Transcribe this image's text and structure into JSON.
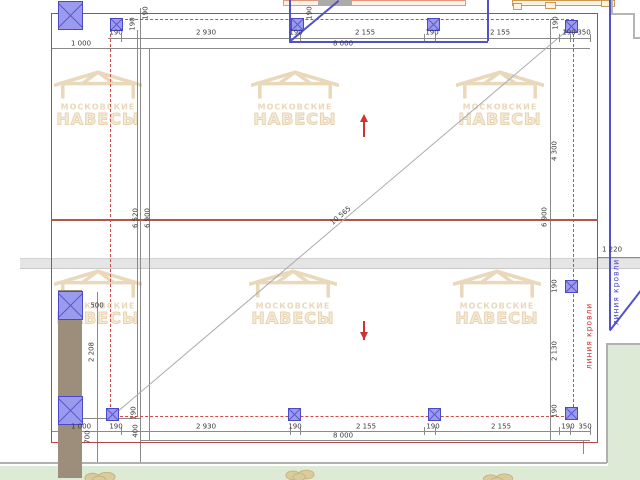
{
  "title": "canopy-plan-drawing",
  "brand": {
    "line1": "МОСКОВСКИЕ",
    "line2": "НАВЕСЫ"
  },
  "colors": {
    "plan_border": "#b84444",
    "dashed": "#cc4c4c",
    "mid_line": "#b05848",
    "blue": "#5252c8",
    "post_fill": "#9a9aee",
    "dim_line": "#8a8a8a",
    "dim_text": "#3a3a3a",
    "watermark": "#e7d2b0",
    "brown": "#9d8d7b",
    "green": "#dcead6",
    "fence": "#e5e5e5",
    "salmon": "#e09878",
    "orange": "#cd9850",
    "grey_struct": "#ababab",
    "red_label": "#cc3333",
    "blue_label": "#4848c8"
  },
  "chart_data": {
    "type": "table",
    "title": "План навеса (размеры, мм)",
    "top_dimensions": [
      "190",
      "2 930",
      "190",
      "2 155",
      "190",
      "2 155",
      "190",
      "350"
    ],
    "top_totals": [
      "1 000",
      "8 000"
    ],
    "bottom_dimensions": [
      "1 000",
      "190",
      "2 930",
      "190",
      "2 155",
      "190",
      "2 155",
      "190",
      "350"
    ],
    "bottom_totals": [
      "8 000"
    ],
    "left_dimensions": [
      "6 520",
      "6 900",
      "500",
      "2 208",
      "190",
      "400",
      "700"
    ],
    "right_dimensions": [
      "190",
      "4 300",
      "190",
      "2 130",
      "190",
      "6 900",
      "350",
      "1 220"
    ],
    "diagonal": "10 565",
    "roof_lines": [
      "линия кровли",
      "линия кровли"
    ]
  },
  "drawing": {
    "diag_label": {
      "t": "10 565",
      "x": 341,
      "y": 216,
      "deg": -40.3
    },
    "roof_labels": [
      {
        "t": "линия кровли",
        "x": 589,
        "y": 336,
        "color": "#cc3333"
      },
      {
        "t": "линия кровли",
        "x": 616,
        "y": 292,
        "color": "#4848c8"
      }
    ],
    "labels_h": [
      {
        "t": "190",
        "x": 116,
        "y": 33
      },
      {
        "t": "2 930",
        "x": 206,
        "y": 33
      },
      {
        "t": "190",
        "x": 296,
        "y": 33
      },
      {
        "t": "2 155",
        "x": 365,
        "y": 33
      },
      {
        "t": "190",
        "x": 432,
        "y": 33
      },
      {
        "t": "2 155",
        "x": 500,
        "y": 33
      },
      {
        "t": "190",
        "x": 569,
        "y": 33
      },
      {
        "t": "350",
        "x": 584,
        "y": 33
      },
      {
        "t": "1 000",
        "x": 81,
        "y": 44
      },
      {
        "t": "8 000",
        "x": 343,
        "y": 44
      },
      {
        "t": "1 000",
        "x": 81,
        "y": 427
      },
      {
        "t": "190",
        "x": 116,
        "y": 427
      },
      {
        "t": "2 930",
        "x": 206,
        "y": 427
      },
      {
        "t": "190",
        "x": 295,
        "y": 427
      },
      {
        "t": "2 155",
        "x": 366,
        "y": 427
      },
      {
        "t": "190",
        "x": 433,
        "y": 427
      },
      {
        "t": "2 155",
        "x": 501,
        "y": 427
      },
      {
        "t": "190",
        "x": 568,
        "y": 427
      },
      {
        "t": "350",
        "x": 585,
        "y": 427
      },
      {
        "t": "8 000",
        "x": 343,
        "y": 436
      },
      {
        "t": "500",
        "x": 97,
        "y": 306
      },
      {
        "t": "1 220",
        "x": 612,
        "y": 250
      }
    ],
    "labels_v": [
      {
        "t": "190",
        "x": 133,
        "y": 24
      },
      {
        "t": "190",
        "x": 146,
        "y": 13
      },
      {
        "t": "190",
        "x": 310,
        "y": 13
      },
      {
        "t": "190",
        "x": 556,
        "y": 23
      },
      {
        "t": "6 520",
        "x": 136,
        "y": 218
      },
      {
        "t": "6 900",
        "x": 148,
        "y": 218
      },
      {
        "t": "2 208",
        "x": 92,
        "y": 352
      },
      {
        "t": "190",
        "x": 134,
        "y": 413
      },
      {
        "t": "400",
        "x": 136,
        "y": 431
      },
      {
        "t": "700",
        "x": 88,
        "y": 437
      },
      {
        "t": "4 300",
        "x": 555,
        "y": 151
      },
      {
        "t": "6 900",
        "x": 545,
        "y": 217
      },
      {
        "t": "190",
        "x": 555,
        "y": 286
      },
      {
        "t": "2 130",
        "x": 555,
        "y": 351
      },
      {
        "t": "190",
        "x": 555,
        "y": 411
      }
    ],
    "dim_hlines": [
      {
        "x": 108,
        "y": 38,
        "w": 482
      },
      {
        "x": 51,
        "y": 48,
        "w": 539
      },
      {
        "x": 51,
        "y": 431,
        "w": 539
      },
      {
        "x": 140,
        "y": 440,
        "w": 450
      },
      {
        "x": 598,
        "y": 257,
        "w": 42
      },
      {
        "x": 82,
        "y": 418,
        "w": 58
      }
    ],
    "dim_vlines": [
      {
        "x": 137,
        "y": 30,
        "h": 387
      },
      {
        "x": 149,
        "y": 48,
        "h": 392
      },
      {
        "x": 550,
        "y": 19,
        "h": 421
      },
      {
        "x": 97,
        "y": 292,
        "h": 170
      },
      {
        "x": 140,
        "y": 8,
        "h": 454
      },
      {
        "x": 583,
        "y": 440,
        "h": 14
      }
    ],
    "ticks_x": [
      121,
      290,
      300,
      424,
      435,
      559,
      570,
      590
    ],
    "posts_small": [
      {
        "x": 110,
        "y": 18
      },
      {
        "x": 291,
        "y": 18
      },
      {
        "x": 427,
        "y": 18
      },
      {
        "x": 565,
        "y": 20
      },
      {
        "x": 106,
        "y": 408
      },
      {
        "x": 288,
        "y": 408
      },
      {
        "x": 428,
        "y": 408
      },
      {
        "x": 565,
        "y": 407
      },
      {
        "x": 565,
        "y": 280
      }
    ],
    "posts_large": [
      {
        "x": 58,
        "y": 1
      },
      {
        "x": 58,
        "y": 291
      },
      {
        "x": 58,
        "y": 396
      }
    ],
    "watermarks": [
      {
        "x": 98,
        "y": 98
      },
      {
        "x": 295,
        "y": 98
      },
      {
        "x": 500,
        "y": 98
      },
      {
        "x": 98,
        "y": 297
      },
      {
        "x": 293,
        "y": 297
      },
      {
        "x": 497,
        "y": 297
      }
    ],
    "arrows": [
      {
        "x": 363,
        "y1": 114,
        "y2": 137,
        "dir": "up"
      },
      {
        "x": 363,
        "y1": 317,
        "y2": 340,
        "dir": "down"
      }
    ],
    "main_diag": {
      "x": 114,
      "y": 414,
      "len": 598,
      "deg": -40.3
    },
    "blue_box": {
      "x1": 289,
      "x2": 487,
      "y2": 41,
      "diag_len": 64,
      "diag_deg": -39.9
    },
    "blue_right_line": {
      "x": 609,
      "y1": 0,
      "y2": 330,
      "diag_len": 51,
      "diag_deg": -52.2
    },
    "grey_steps": [
      {
        "x": 611,
        "y": 0,
        "w": 2,
        "h": 13
      },
      {
        "x": 611,
        "y": 13,
        "w": 22,
        "h": 2
      },
      {
        "x": 633,
        "y": 13,
        "w": 2,
        "h": 24
      },
      {
        "x": 633,
        "y": 37,
        "w": 7,
        "h": 2
      }
    ],
    "bushes": [
      {
        "x": 84,
        "y": 468,
        "w": 32,
        "h": 12
      },
      {
        "x": 285,
        "y": 466,
        "w": 30,
        "h": 13
      },
      {
        "x": 481,
        "y": 469,
        "w": 34,
        "h": 11
      }
    ]
  }
}
